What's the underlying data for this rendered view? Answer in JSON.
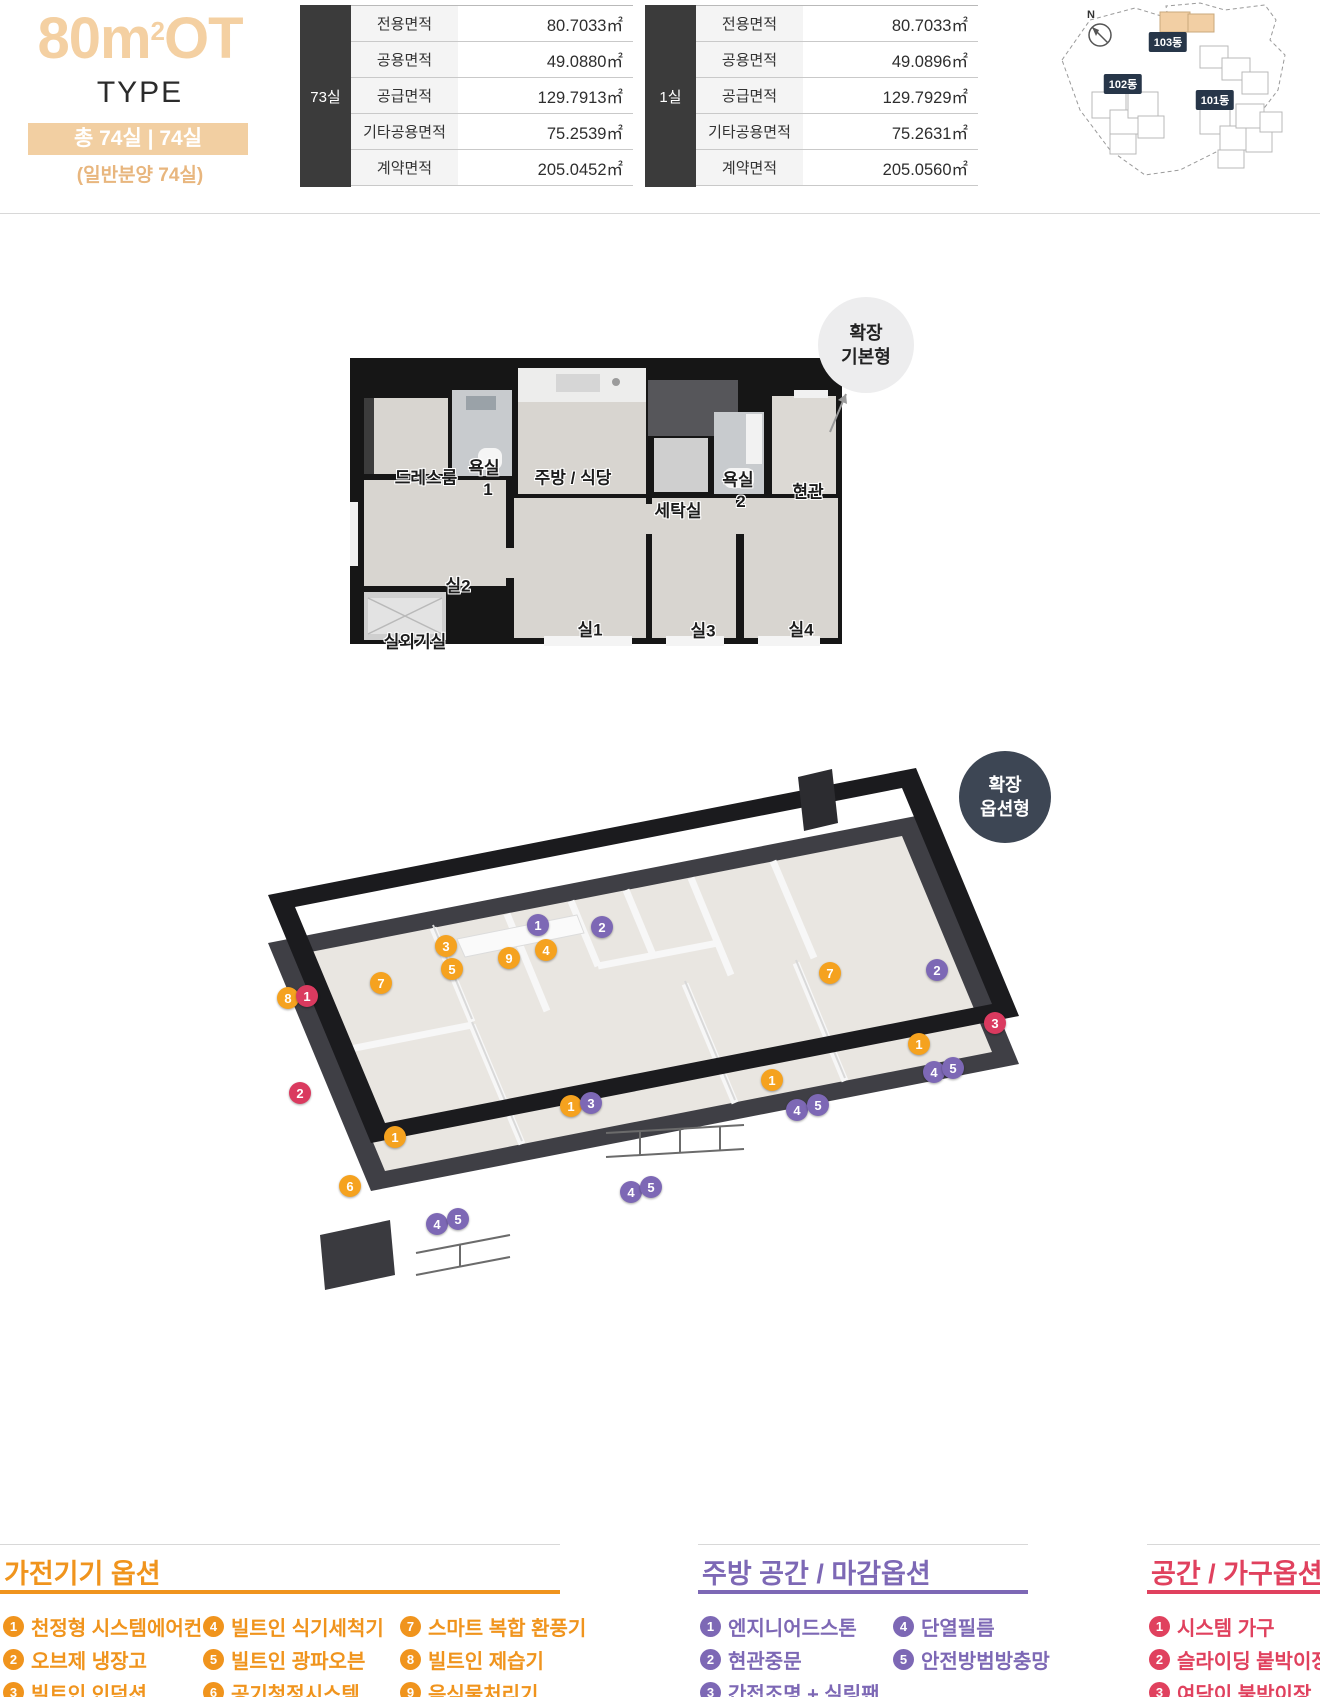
{
  "header": {
    "title_prefix": "80m",
    "title_sup": "2",
    "title_suffix": "OT",
    "type_label": "TYPE",
    "badge": "총 74실 | 74실",
    "note": "(일반분양 74실)"
  },
  "area_tables": [
    {
      "unit": "73실",
      "rows": [
        {
          "label": "전용면적",
          "value": "80.7033㎡"
        },
        {
          "label": "공용면적",
          "value": "49.0880㎡"
        },
        {
          "label": "공급면적",
          "value": "129.7913㎡"
        },
        {
          "label": "기타공용면적",
          "value": "75.2539㎡"
        },
        {
          "label": "계약면적",
          "value": "205.0452㎡"
        }
      ]
    },
    {
      "unit": "1실",
      "rows": [
        {
          "label": "전용면적",
          "value": "80.7033㎡"
        },
        {
          "label": "공용면적",
          "value": "49.0896㎡"
        },
        {
          "label": "공급면적",
          "value": "129.7929㎡"
        },
        {
          "label": "기타공용면적",
          "value": "75.2631㎡"
        },
        {
          "label": "계약면적",
          "value": "205.0560㎡"
        }
      ]
    }
  ],
  "site_map": {
    "compass_label": "N",
    "highlight_color": "#f2cfa4",
    "buildings": [
      {
        "label": "103동",
        "x": 118,
        "y": 42
      },
      {
        "label": "102동",
        "x": 73,
        "y": 84
      },
      {
        "label": "101동",
        "x": 165,
        "y": 100
      }
    ]
  },
  "plan2d": {
    "badge_line1": "확장",
    "badge_line2": "기본형",
    "labels": [
      {
        "t": "드레스룸",
        "x": 78,
        "y": 124
      },
      {
        "t": "욕실",
        "x": 136,
        "y": 114
      },
      {
        "t": "1",
        "x": 140,
        "y": 138
      },
      {
        "t": "주방 / 식당",
        "x": 225,
        "y": 124
      },
      {
        "t": "세탁실",
        "x": 330,
        "y": 157
      },
      {
        "t": "욕실",
        "x": 390,
        "y": 126
      },
      {
        "t": "2",
        "x": 393,
        "y": 150
      },
      {
        "t": "현관",
        "x": 460,
        "y": 138
      },
      {
        "t": "실2",
        "x": 110,
        "y": 232
      },
      {
        "t": "실1",
        "x": 242,
        "y": 276
      },
      {
        "t": "실3",
        "x": 355,
        "y": 277
      },
      {
        "t": "실4",
        "x": 453,
        "y": 276
      },
      {
        "t": "실외기실",
        "x": 67,
        "y": 288
      }
    ]
  },
  "plan3d": {
    "badge_line1": "확장",
    "badge_line2": "옵션형",
    "marker_colors": {
      "o": "#f5a21f",
      "p": "#7d68b5",
      "r": "#da3a5f"
    },
    "markers": [
      {
        "n": "8",
        "c": "o",
        "x": 108,
        "y": 233
      },
      {
        "n": "1",
        "c": "r",
        "x": 127,
        "y": 231
      },
      {
        "n": "7",
        "c": "o",
        "x": 201,
        "y": 218
      },
      {
        "n": "3",
        "c": "o",
        "x": 266,
        "y": 181
      },
      {
        "n": "5",
        "c": "o",
        "x": 272,
        "y": 204
      },
      {
        "n": "9",
        "c": "o",
        "x": 329,
        "y": 193
      },
      {
        "n": "4",
        "c": "o",
        "x": 366,
        "y": 185
      },
      {
        "n": "1",
        "c": "p",
        "x": 358,
        "y": 160
      },
      {
        "n": "2",
        "c": "p",
        "x": 422,
        "y": 162
      },
      {
        "n": "2",
        "c": "r",
        "x": 120,
        "y": 328
      },
      {
        "n": "1",
        "c": "o",
        "x": 215,
        "y": 372
      },
      {
        "n": "6",
        "c": "o",
        "x": 170,
        "y": 421
      },
      {
        "n": "1",
        "c": "o",
        "x": 391,
        "y": 341
      },
      {
        "n": "3",
        "c": "p",
        "x": 411,
        "y": 338
      },
      {
        "n": "4",
        "c": "p",
        "x": 451,
        "y": 427
      },
      {
        "n": "5",
        "c": "p",
        "x": 471,
        "y": 422
      },
      {
        "n": "4",
        "c": "p",
        "x": 257,
        "y": 459
      },
      {
        "n": "5",
        "c": "p",
        "x": 278,
        "y": 454
      },
      {
        "n": "7",
        "c": "o",
        "x": 650,
        "y": 208
      },
      {
        "n": "2",
        "c": "p",
        "x": 757,
        "y": 205
      },
      {
        "n": "3",
        "c": "r",
        "x": 815,
        "y": 258
      },
      {
        "n": "1",
        "c": "o",
        "x": 592,
        "y": 315
      },
      {
        "n": "4",
        "c": "p",
        "x": 617,
        "y": 345
      },
      {
        "n": "5",
        "c": "p",
        "x": 638,
        "y": 340
      },
      {
        "n": "1",
        "c": "o",
        "x": 739,
        "y": 279
      },
      {
        "n": "4",
        "c": "p",
        "x": 754,
        "y": 307
      },
      {
        "n": "5",
        "c": "p",
        "x": 773,
        "y": 303
      }
    ]
  },
  "legends": [
    {
      "title": "가전기기 옵션",
      "color": "#f0941d",
      "x": 0,
      "width": 560,
      "columns": [
        {
          "x": 3,
          "items": [
            {
              "n": "1",
              "label": "천정형 시스템에어컨"
            },
            {
              "n": "2",
              "label": "오브제 냉장고"
            },
            {
              "n": "3",
              "label": "빌트인 인덕션"
            }
          ]
        },
        {
          "x": 203,
          "items": [
            {
              "n": "4",
              "label": "빌트인 식기세척기"
            },
            {
              "n": "5",
              "label": "빌트인 광파오븐"
            },
            {
              "n": "6",
              "label": "공기청정시스템"
            }
          ]
        },
        {
          "x": 400,
          "items": [
            {
              "n": "7",
              "label": "스마트 복합 환풍기"
            },
            {
              "n": "8",
              "label": "빌트인 제습기"
            },
            {
              "n": "9",
              "label": "음식물처리기"
            }
          ]
        }
      ]
    },
    {
      "title": "주방 공간 / 마감옵션",
      "color": "#7d68b5",
      "x": 698,
      "width": 330,
      "columns": [
        {
          "x": 700,
          "items": [
            {
              "n": "1",
              "label": "엔지니어드스톤"
            },
            {
              "n": "2",
              "label": "현관중문"
            },
            {
              "n": "3",
              "label": "간접조명 + 실링팬"
            }
          ]
        },
        {
          "x": 893,
          "items": [
            {
              "n": "4",
              "label": "단열필름"
            },
            {
              "n": "5",
              "label": "안전방범방충망"
            }
          ]
        }
      ]
    },
    {
      "title": "공간 / 가구옵션",
      "color": "#e0415e",
      "x": 1147,
      "width": 173,
      "columns": [
        {
          "x": 1149,
          "items": [
            {
              "n": "1",
              "label": "시스템 가구"
            },
            {
              "n": "2",
              "label": "슬라이딩 붙박이장"
            },
            {
              "n": "3",
              "label": "여닫이 붙박이장"
            }
          ]
        }
      ]
    }
  ]
}
